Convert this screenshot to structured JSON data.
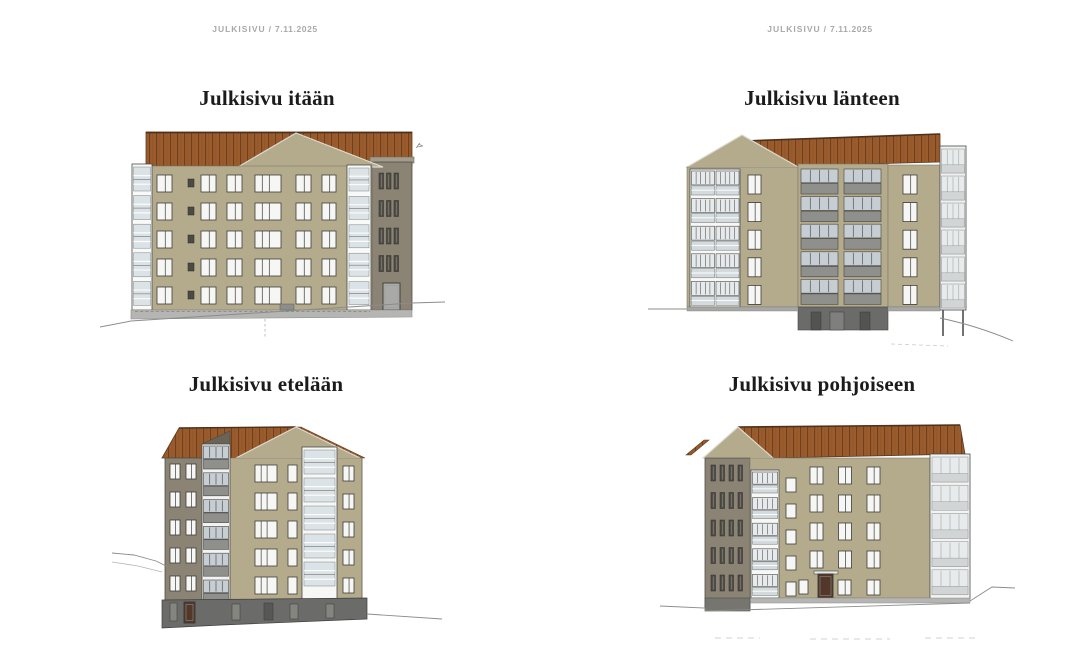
{
  "header_left": {
    "label": "JULKISIVU",
    "separator": "/",
    "date": "7.11.2025"
  },
  "header_right": {
    "label": "JULKISIVU",
    "separator": "/",
    "date": "7.11.2025"
  },
  "panels": [
    {
      "id": "east",
      "title": "Julkisivu itään"
    },
    {
      "id": "west",
      "title": "Julkisivu länteen"
    },
    {
      "id": "south",
      "title": "Julkisivu etelään"
    },
    {
      "id": "north",
      "title": "Julkisivu pohjoiseen"
    }
  ],
  "colors": {
    "wall": "#b3ab8b",
    "wall_dark": "#8b8373",
    "roof": "#9a5c2d",
    "roof_seam": "#6f3f1e",
    "window_frame": "#3d3d3b",
    "window_glass": "#f6f6f4",
    "balcony_glass": "#dce3e7",
    "base_light": "#b5b5b3",
    "base_dark": "#6b6b69",
    "ground_line": "#8c8c8a",
    "door_brown": "#53382a",
    "title_text": "#1b1b1b",
    "header_text": "#a9a9a9"
  }
}
